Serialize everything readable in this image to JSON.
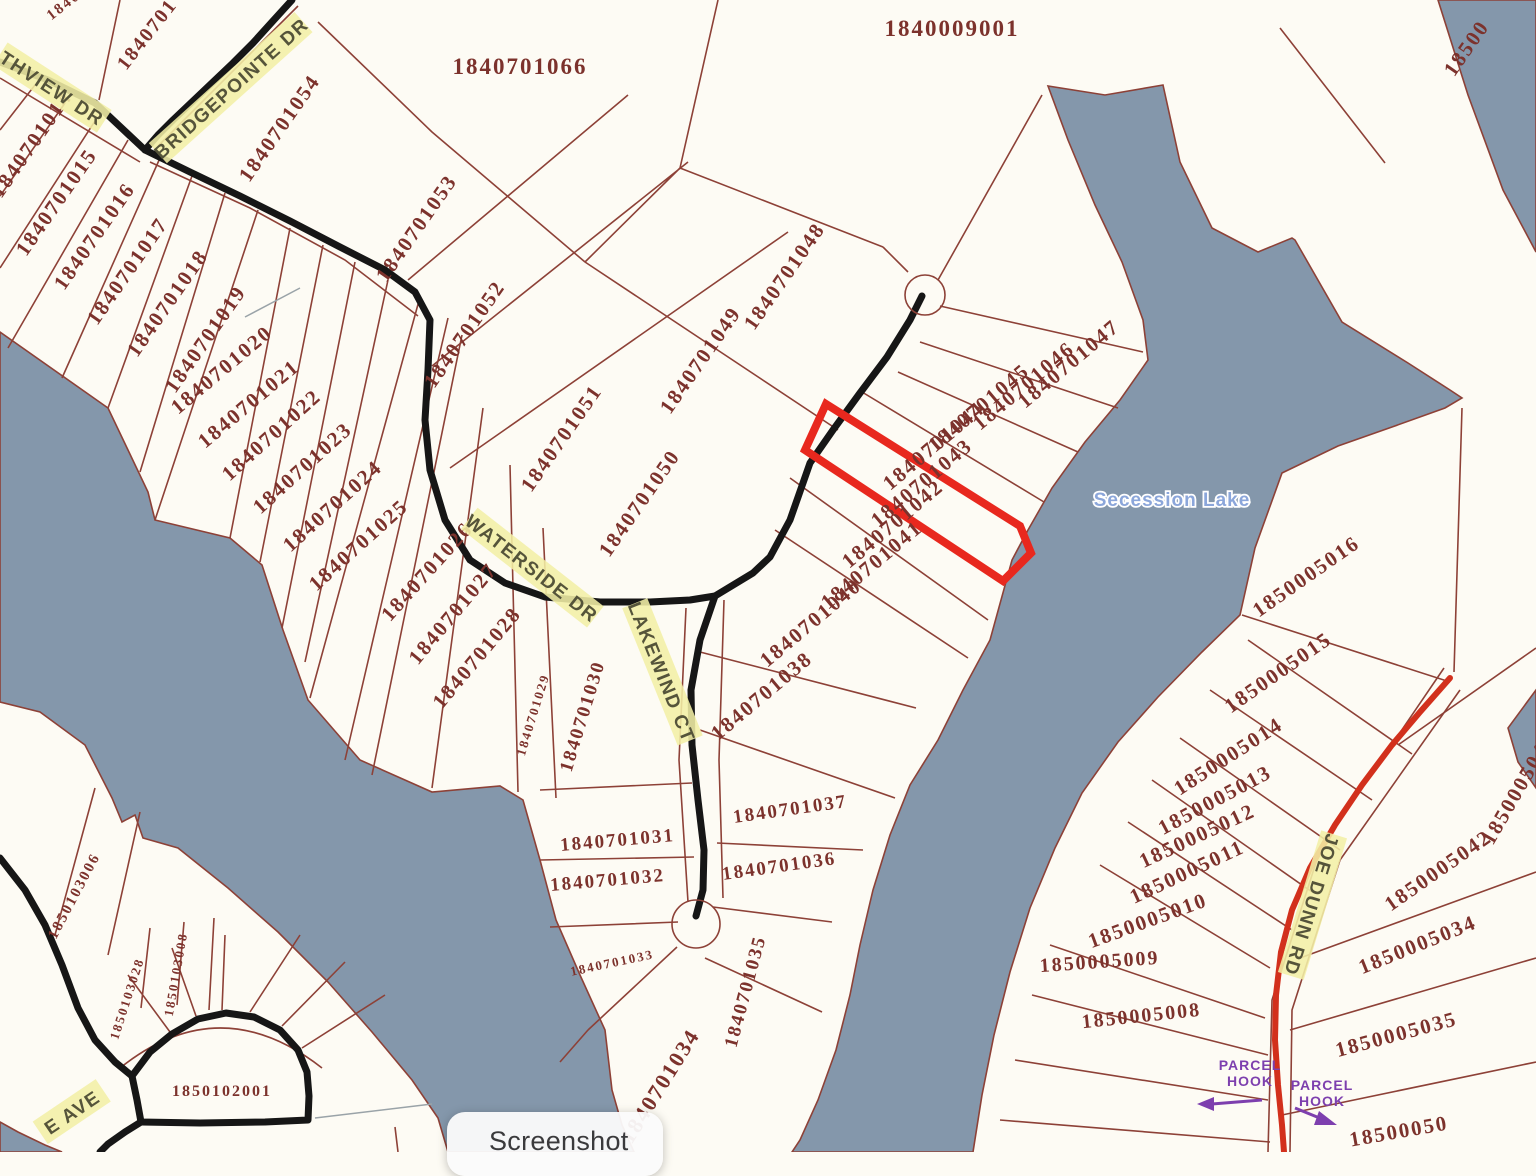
{
  "map": {
    "colors": {
      "water": "#8497ab",
      "land": "#fdfbf4",
      "parcel_line": "#8d4137",
      "parcel_text": "#7c322c",
      "road_black": "#161616",
      "road_red": "#d2301c",
      "highlight_red": "#e8281e",
      "road_label_bg": "#f3efa6",
      "road_label_fg": "#55543a",
      "lake_text": "#8ba6da",
      "hook_purple": "#7d3fae",
      "leader_gray": "#9aa3a8"
    },
    "lake": {
      "name": "Secession Lake",
      "x": 1172,
      "y": 506,
      "s": 19
    },
    "highlight": {
      "parcel_id": "1840701043"
    },
    "road_labels": [
      {
        "text": "THVIEW DR",
        "x": 52,
        "y": 88,
        "r": 33
      },
      {
        "text": "BRIDGEPOINTE DR",
        "x": 231,
        "y": 88,
        "r": -42
      },
      {
        "text": "WATERSIDE DR",
        "x": 532,
        "y": 568,
        "r": 38
      },
      {
        "text": "LAKEWIND CT",
        "x": 662,
        "y": 672,
        "r": 68
      },
      {
        "text": "JOE DUNN RD",
        "x": 1312,
        "y": 905,
        "r": 107
      },
      {
        "text": "E AVE",
        "x": 72,
        "y": 1112,
        "r": -34
      }
    ],
    "parcel_labels": [
      {
        "text": "1840009001",
        "x": 952,
        "y": 36,
        "r": 0,
        "s": 23
      },
      {
        "text": "1840701066",
        "x": 520,
        "y": 74,
        "r": 0,
        "s": 23
      },
      {
        "text": "18407",
        "x": 70,
        "y": 6,
        "r": -38,
        "s": 15
      },
      {
        "text": "1840701",
        "x": 152,
        "y": 38,
        "r": -52,
        "s": 20
      },
      {
        "text": "1840701054",
        "x": 285,
        "y": 132,
        "r": -55,
        "s": 21
      },
      {
        "text": "1840701053",
        "x": 422,
        "y": 232,
        "r": -55,
        "s": 21
      },
      {
        "text": "1840701052",
        "x": 470,
        "y": 338,
        "r": -55,
        "s": 21
      },
      {
        "text": "1840701051",
        "x": 567,
        "y": 442,
        "r": -55,
        "s": 21
      },
      {
        "text": "1840701050",
        "x": 645,
        "y": 507,
        "r": -55,
        "s": 21
      },
      {
        "text": "1840701048",
        "x": 790,
        "y": 280,
        "r": -55,
        "s": 21
      },
      {
        "text": "1840701049",
        "x": 706,
        "y": 364,
        "r": -55,
        "s": 21
      },
      {
        "text": "1840701047",
        "x": 1073,
        "y": 369,
        "r": -40,
        "s": 21
      },
      {
        "text": "1840701046",
        "x": 1028,
        "y": 391,
        "r": -40,
        "s": 21
      },
      {
        "text": "1840701045",
        "x": 983,
        "y": 413,
        "r": -40,
        "s": 21
      },
      {
        "text": "1840701044",
        "x": 938,
        "y": 451,
        "r": -40,
        "s": 21
      },
      {
        "text": "1840701043",
        "x": 926,
        "y": 488,
        "r": -40,
        "s": 21
      },
      {
        "text": "1840701042",
        "x": 897,
        "y": 529,
        "r": -40,
        "s": 21
      },
      {
        "text": "1840701041",
        "x": 876,
        "y": 570,
        "r": -40,
        "s": 21
      },
      {
        "text": "1840701040",
        "x": 815,
        "y": 628,
        "r": -40,
        "s": 21
      },
      {
        "text": "1840701038",
        "x": 766,
        "y": 701,
        "r": -40,
        "s": 21
      },
      {
        "text": "1840701037",
        "x": 791,
        "y": 815,
        "r": -8,
        "s": 19
      },
      {
        "text": "1840701036",
        "x": 780,
        "y": 872,
        "r": -8,
        "s": 19
      },
      {
        "text": "1840701035",
        "x": 751,
        "y": 993,
        "r": -75,
        "s": 19
      },
      {
        "text": "1840701034",
        "x": 666,
        "y": 1090,
        "r": -58,
        "s": 22
      },
      {
        "text": "1840701031",
        "x": 618,
        "y": 846,
        "r": -5,
        "s": 19
      },
      {
        "text": "1840701032",
        "x": 608,
        "y": 886,
        "r": -5,
        "s": 19
      },
      {
        "text": "1840701033",
        "x": 613,
        "y": 967,
        "r": -12,
        "s": 13
      },
      {
        "text": "1840701030",
        "x": 588,
        "y": 718,
        "r": -73,
        "s": 19
      },
      {
        "text": "1840701029",
        "x": 537,
        "y": 716,
        "r": -73,
        "s": 13
      },
      {
        "text": "1840701028",
        "x": 482,
        "y": 662,
        "r": -50,
        "s": 21
      },
      {
        "text": "1840701027",
        "x": 458,
        "y": 618,
        "r": -50,
        "s": 21
      },
      {
        "text": "1840701026",
        "x": 432,
        "y": 576,
        "r": -48,
        "s": 21
      },
      {
        "text": "1840701025",
        "x": 363,
        "y": 550,
        "r": -42,
        "s": 21
      },
      {
        "text": "1840701024",
        "x": 337,
        "y": 511,
        "r": -42,
        "s": 21
      },
      {
        "text": "1840701023",
        "x": 307,
        "y": 473,
        "r": -42,
        "s": 21
      },
      {
        "text": "1840701022",
        "x": 276,
        "y": 440,
        "r": -42,
        "s": 21
      },
      {
        "text": "1840701021",
        "x": 253,
        "y": 409,
        "r": -40,
        "s": 21
      },
      {
        "text": "1840701020",
        "x": 226,
        "y": 375,
        "r": -40,
        "s": 21
      },
      {
        "text": "1840701019",
        "x": 211,
        "y": 343,
        "r": -55,
        "s": 21
      },
      {
        "text": "1840701018",
        "x": 173,
        "y": 307,
        "r": -55,
        "s": 21
      },
      {
        "text": "1840701017",
        "x": 133,
        "y": 275,
        "r": -55,
        "s": 21
      },
      {
        "text": "1840701016",
        "x": 100,
        "y": 240,
        "r": -55,
        "s": 21
      },
      {
        "text": "1840701015",
        "x": 62,
        "y": 206,
        "r": -55,
        "s": 21
      },
      {
        "text": "1840701014",
        "x": 37,
        "y": 148,
        "r": -55,
        "s": 21
      },
      {
        "text": "18500",
        "x": 1472,
        "y": 52,
        "r": -55,
        "s": 21
      },
      {
        "text": "1850005016",
        "x": 1310,
        "y": 582,
        "r": -35,
        "s": 21
      },
      {
        "text": "1850005015",
        "x": 1282,
        "y": 678,
        "r": -35,
        "s": 21
      },
      {
        "text": "1850005014",
        "x": 1232,
        "y": 762,
        "r": -33,
        "s": 21
      },
      {
        "text": "1850005013",
        "x": 1218,
        "y": 806,
        "r": -28,
        "s": 21
      },
      {
        "text": "1850005012",
        "x": 1200,
        "y": 842,
        "r": -25,
        "s": 21
      },
      {
        "text": "1850005011",
        "x": 1190,
        "y": 878,
        "r": -25,
        "s": 21
      },
      {
        "text": "1850005010",
        "x": 1150,
        "y": 927,
        "r": -20,
        "s": 21
      },
      {
        "text": "1850005009",
        "x": 1100,
        "y": 968,
        "r": -4,
        "s": 20
      },
      {
        "text": "1850005008",
        "x": 1142,
        "y": 1022,
        "r": -6,
        "s": 20
      },
      {
        "text": "1850005042",
        "x": 1442,
        "y": 876,
        "r": -35,
        "s": 21
      },
      {
        "text": "1850005043",
        "x": 1524,
        "y": 792,
        "r": -60,
        "s": 21
      },
      {
        "text": "1850005034",
        "x": 1420,
        "y": 951,
        "r": -22,
        "s": 21
      },
      {
        "text": "1850005035",
        "x": 1398,
        "y": 1041,
        "r": -15,
        "s": 21
      },
      {
        "text": "18500050",
        "x": 1400,
        "y": 1138,
        "r": -10,
        "s": 21
      },
      {
        "text": "1850103006",
        "x": 78,
        "y": 898,
        "r": -62,
        "s": 15
      },
      {
        "text": "1850103028",
        "x": 131,
        "y": 1000,
        "r": -72,
        "s": 13
      },
      {
        "text": "1850103008",
        "x": 180,
        "y": 975,
        "r": -80,
        "s": 13
      },
      {
        "text": "1850102001",
        "x": 222,
        "y": 1096,
        "r": 0,
        "s": 16
      }
    ],
    "hook_labels": [
      {
        "line1": "PARCEL",
        "line2": "HOOK",
        "x": 1250,
        "y": 1070
      },
      {
        "line1": "PARCEL",
        "line2": "HOOK",
        "x": 1322,
        "y": 1090
      }
    ]
  },
  "overlay": {
    "screenshot_label": "Screenshot"
  }
}
